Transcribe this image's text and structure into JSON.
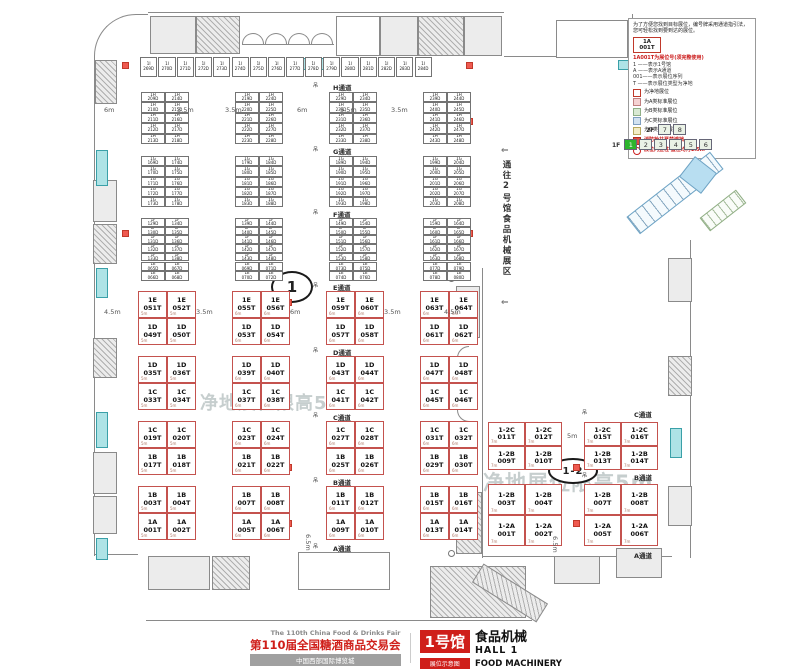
{
  "legend": {
    "intro": "为了方便您找到目标展位，编号牌采用通道指引法，您可轻松找到要到达的展位。",
    "sample_code_line1": "1A",
    "sample_code_line2": "001T",
    "code_note": "1A001T为展位号(须完整使用)",
    "code_lines": [
      "1 ——表示1号馆",
      "A ——表示A通道",
      "001——表示展位序列",
      "T ——表示展位类型为净地"
    ],
    "items": [
      {
        "label": "为净地展位",
        "fill": "#ffffff",
        "border": "#c0392b"
      },
      {
        "label": "为A类标准展位",
        "fill": "#f5d3d3",
        "border": "#c08080"
      },
      {
        "label": "为B类标准展位",
        "fill": "#d9e9d3",
        "border": "#8faf86"
      },
      {
        "label": "为C类标准展位",
        "fill": "#d2e2f0",
        "border": "#7f9fc0"
      },
      {
        "label": "为D类标准展位",
        "fill": "#f2ecc6",
        "border": "#b8a95f"
      }
    ],
    "fire_note": "消防栓井严禁遮挡",
    "column_note": "展位内立柱 直径均为1.5m"
  },
  "floor_selector": {
    "upper_label": "2F",
    "upper": [
      "7",
      "8"
    ],
    "lower_label": "1F",
    "lower": [
      "1",
      "2",
      "3",
      "4",
      "5",
      "6"
    ],
    "active": "1"
  },
  "plan": {
    "corridor_to_hall2": "通往2号馆食品机械展区",
    "watermark": "净地展位限高5m",
    "hall_marker": "1",
    "annex_marker": "1-2",
    "hoist_symbol": "吊",
    "arrow": "⇐",
    "dims_top": [
      "6m",
      "3.5m",
      "3.5m",
      "6m",
      "5.5m",
      "3.5m"
    ],
    "dims_mid": [
      "4.5m",
      "3.5m",
      "6m",
      "3.5m",
      "4.5m"
    ],
    "dim_annex_gap": "5m",
    "dim_left_bottom": "6.5m",
    "dim_annex_bottom": "6.5m"
  },
  "booths": {
    "top_strip": {
      "prefix": "1I",
      "suffix": "D",
      "start": 269,
      "count": 16
    },
    "standard_groups": [
      {
        "aisle": "H通道",
        "prefix": "1H",
        "suffix": "D",
        "start": 209,
        "rows": 5
      },
      {
        "aisle": "G通道",
        "prefix": "1G",
        "suffix": "D",
        "start": 169,
        "rows": 5
      },
      {
        "aisle": "F通道",
        "prefix": "1F",
        "suffix": "D",
        "start": 129,
        "rows": 5
      },
      {
        "aisle": "",
        "prefix": "1E",
        "suffix": "D",
        "start": 65,
        "rows": 2
      }
    ],
    "net_bands": [
      {
        "aisle": "E通道",
        "row_prefixes": [
          "1E",
          "1D"
        ],
        "row_numbers": [
          [
            51,
            52,
            55,
            56,
            59,
            60,
            63,
            64
          ],
          [
            49,
            50,
            53,
            54,
            57,
            58,
            61,
            62
          ]
        ]
      },
      {
        "aisle": "D通道",
        "row_prefixes": [
          "1D",
          "1C"
        ],
        "row_numbers": [
          [
            35,
            36,
            39,
            40,
            43,
            44,
            47,
            48
          ],
          [
            33,
            34,
            37,
            38,
            41,
            42,
            45,
            46
          ]
        ]
      },
      {
        "aisle": "C通道",
        "row_prefixes": [
          "1C",
          "1B"
        ],
        "row_numbers": [
          [
            19,
            20,
            23,
            24,
            27,
            28,
            31,
            32
          ],
          [
            17,
            18,
            21,
            22,
            25,
            26,
            29,
            30
          ]
        ]
      },
      {
        "aisle": "B通道",
        "row_prefixes": [
          "1B",
          "1A"
        ],
        "row_numbers": [
          [
            3,
            4,
            7,
            8,
            11,
            12,
            15,
            16
          ],
          [
            1,
            2,
            5,
            6,
            9,
            10,
            13,
            14
          ]
        ]
      }
    ],
    "main_bottom_aisle": "A通道",
    "net_cell_dim_first_block": "5m",
    "net_cell_dim": "6m",
    "annex_bands": [
      {
        "aisle": "C通道",
        "row_prefixes": [
          "1-2C",
          "1-2B"
        ],
        "row_numbers": [
          [
            11,
            12,
            15,
            16
          ],
          [
            9,
            10,
            13,
            14
          ]
        ]
      },
      {
        "aisle": "B通道",
        "row_prefixes": [
          "1-2B",
          "1-2A"
        ],
        "row_numbers": [
          [
            3,
            4,
            7,
            8
          ],
          [
            1,
            2,
            5,
            6
          ]
        ]
      }
    ],
    "annex_bottom_aisle": "A通道",
    "annex_cell_dim": "7m"
  },
  "title_block": {
    "fair_en": "The 110th China Food & Drinks Fair",
    "fair_cn": "第110届全国糖酒商品交易会",
    "venue": "中国西部国际博览城",
    "hall_badge": "1号馆",
    "hall_name_cn": "食品机械",
    "hall_name_en": "HALL 1",
    "hall_name_en2": "FOOD MACHINERY",
    "map_badge": "展位示意图"
  }
}
